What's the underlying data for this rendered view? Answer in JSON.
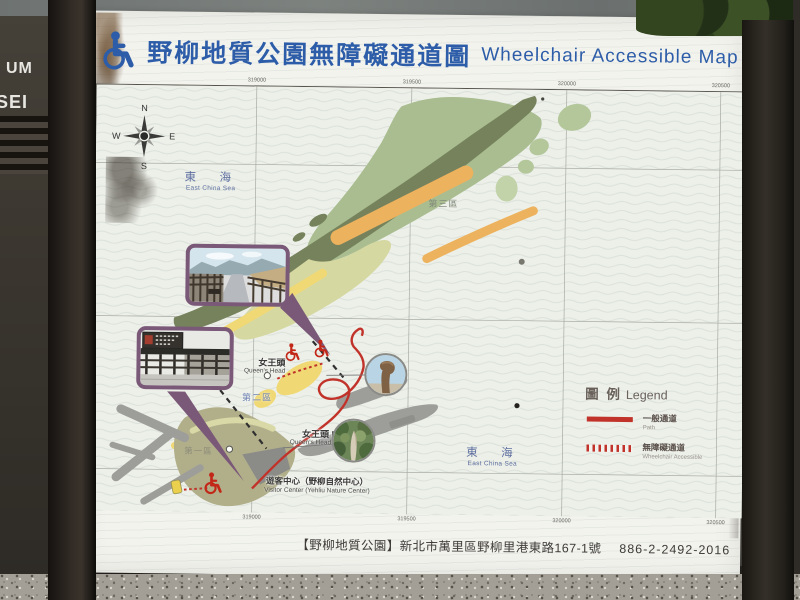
{
  "header": {
    "title_zh": "野柳地質公園無障礙通道圖",
    "title_en": "Wheelchair  Accessible  Map"
  },
  "map": {
    "compass": {
      "n": "N",
      "e": "E",
      "s": "S",
      "w": "W"
    },
    "sea_label": {
      "zh": "東　海",
      "en": "East China Sea"
    },
    "areas": {
      "area1": "第一區",
      "area2": "第二區",
      "area3": "第三區"
    },
    "poi": {
      "queens_head": {
        "zh": "女王頭",
        "en": "Queen's Head"
      },
      "queens_head_2": {
        "zh": "女王頭 II",
        "en": "Queen's Head II"
      },
      "visitor_center": {
        "zh": "遊客中心（野柳自然中心）",
        "en": "Visitor Center (Yehliu Nature Center)"
      }
    },
    "ticks": {
      "t0": "319000",
      "t1": "319500",
      "t2": "320000",
      "t3": "320500"
    }
  },
  "legend": {
    "title_zh": "圖 例",
    "title_en": "Legend",
    "path_zh": "一般通道",
    "path_en": "Path",
    "accessible_zh": "無障礙通道",
    "accessible_en": "Wheelchair Accessible"
  },
  "footer": {
    "name": "【野柳地質公園】",
    "address": "新北市萬里區野柳里港東路167-1號",
    "phone": "886-2-2492-2016"
  },
  "surroundings": {
    "left_sign_line1": "UM",
    "left_sign_line2": "SEI"
  },
  "colors": {
    "title_blue": "#2d5da8",
    "path_red": "#c1332a",
    "inset_purple": "#7a5878",
    "sea": "#edf0e9"
  }
}
